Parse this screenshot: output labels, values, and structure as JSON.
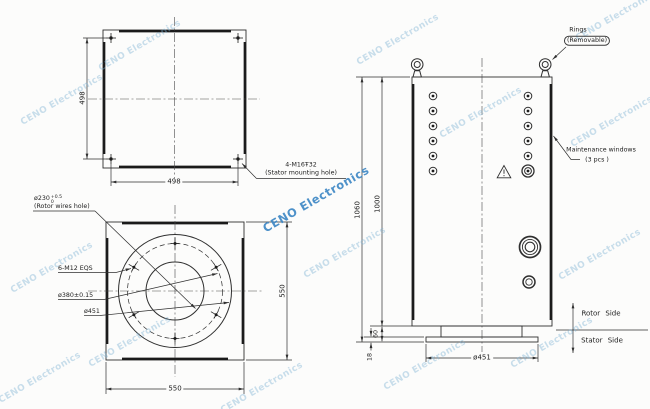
{
  "watermark": {
    "text": "CENO Electronics"
  },
  "colors": {
    "background": "#fcfcfb",
    "line": "#2f2f2f",
    "watermark_light": "#7fb3d5",
    "watermark_strong": "#3f88c5"
  },
  "stator_view": {
    "dim_height": "498",
    "dim_width": "498",
    "mounting_hole_callout_line1": "4-M16Ŧ32",
    "mounting_hole_callout_line2": "(Stator mounting hole)"
  },
  "rotor_view": {
    "dim_height": "550",
    "dim_width": "550",
    "wires_hole_dia": "ø230",
    "wires_hole_tol_upper": "+0.5",
    "wires_hole_tol_lower": "0",
    "wires_hole_label": "(Rotor wires hole)",
    "bolt_pattern_label": "6-M12 EQS",
    "bolt_circle_dia": "ø380±0.15",
    "outer_dia": "ø451"
  },
  "side_view": {
    "dim_overall_height": "1060",
    "dim_body_height": "1000",
    "dim_base_height": "60",
    "dim_flange_thickness": "18",
    "flange_dia": "ø451",
    "rings_label_line1": "Rings",
    "rings_label_line2": "(Removable)",
    "maintenance_label_line1": "Maintenance windows",
    "maintenance_label_line2": "(3 pcs )",
    "rotor_side_label": "Rotor Side",
    "stator_side_label": "Stator Side"
  }
}
